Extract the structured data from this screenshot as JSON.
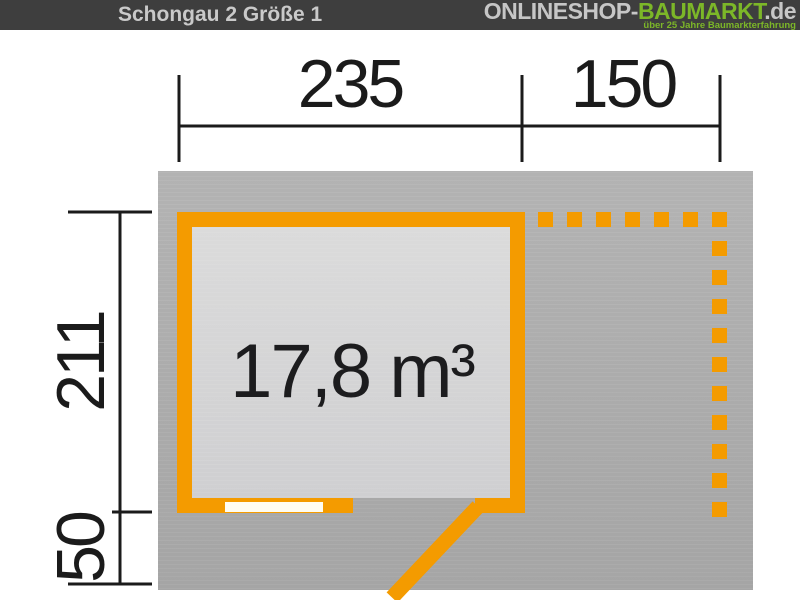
{
  "header": {
    "title": "Schongau 2 Größe 1",
    "logo": {
      "shop": "ONLINESHOP-",
      "brand": "BAUMARKT",
      "tld": ".de",
      "tagline": "über 25 Jahre Baumarkterfahrung"
    }
  },
  "plan": {
    "volume": "17,8 m³",
    "dimensions": {
      "top_main_width_cm": "235",
      "top_side_roof_cm": "150",
      "left_depth_cm": "211",
      "left_front_overhang_cm": "50"
    }
  },
  "colors": {
    "accent_orange": "#F49B00",
    "logo_green": "#7CB728",
    "header_dark": "#3E3E3E",
    "ground_gray": "#ABABAB",
    "room_gray": "#D5D5D6",
    "dimension_black": "#1B1B1B",
    "window_white": "#FFFDF2"
  }
}
